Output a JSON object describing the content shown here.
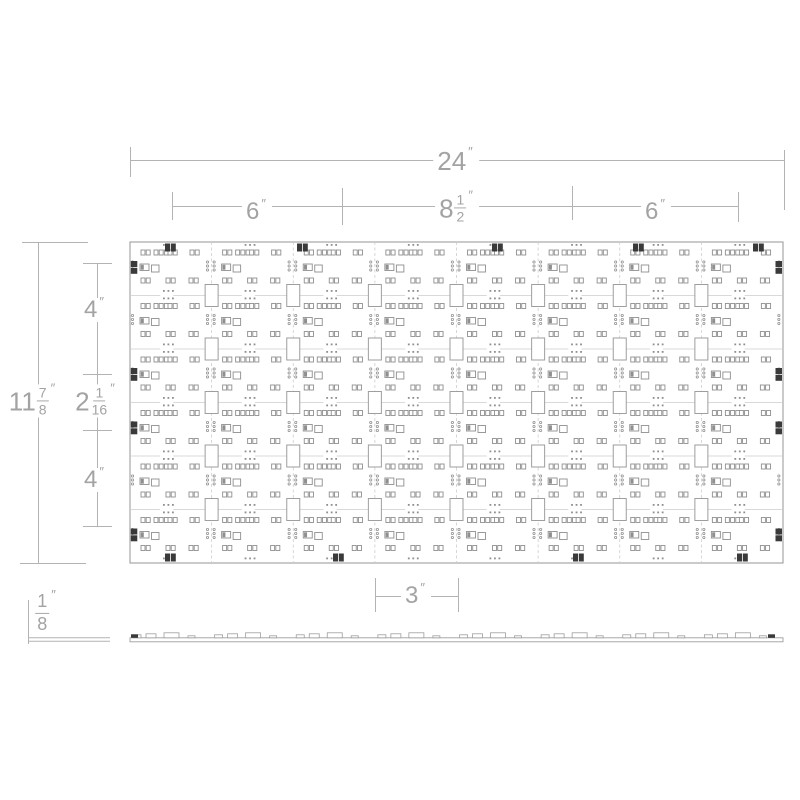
{
  "colors": {
    "dimension_line": "#b3b3b3",
    "dimension_text": "#a3a3a3",
    "board_outline": "#9e9e9e",
    "grid_line": "#cccccc",
    "pad_line": "#8f8f8f",
    "fiducial_dark": "#3a3a3a"
  },
  "dimensions": {
    "width_total": {
      "value": "24",
      "unit": "″"
    },
    "width_left": {
      "value": "6",
      "unit": "″"
    },
    "width_center": {
      "whole": "8",
      "numerator": "1",
      "denominator": "2",
      "unit": "″"
    },
    "width_right": {
      "value": "6",
      "unit": "″"
    },
    "height_total": {
      "whole": "11",
      "numerator": "7",
      "denominator": "8",
      "unit": "″"
    },
    "height_top": {
      "value": "4",
      "unit": "″"
    },
    "height_center": {
      "whole": "2",
      "numerator": "1",
      "denominator": "16",
      "unit": "″"
    },
    "height_bottom": {
      "value": "4",
      "unit": "″"
    },
    "detail_width": {
      "value": "3",
      "unit": "″"
    },
    "thickness": {
      "numerator": "1",
      "denominator": "8",
      "unit": "″"
    }
  },
  "board": {
    "x": 130,
    "y": 242,
    "w": 653,
    "h": 321,
    "cols": 8,
    "rows": 6,
    "tab": {
      "w": 13,
      "h": 22
    },
    "cell_items": [
      [
        "d3",
        33,
        2
      ],
      [
        "pp",
        11,
        8
      ],
      [
        "p3",
        24,
        8
      ],
      [
        "pp",
        38,
        8
      ],
      [
        "pp",
        60,
        8
      ],
      [
        "c3",
        2.5,
        20
      ],
      [
        "ic",
        10,
        22
      ],
      [
        "sq",
        21.5,
        23
      ],
      [
        "c3",
        77.5,
        20
      ],
      [
        "pp",
        11,
        36
      ],
      [
        "pp",
        36,
        36
      ],
      [
        "pp",
        59,
        36
      ],
      [
        "d3",
        33,
        48
      ]
    ],
    "top_dark_marks_x": [
      165,
      297,
      492,
      633,
      753
    ],
    "bottom_dark_marks_x": [
      165,
      333,
      573,
      737
    ],
    "left_dark_rows": [
      0,
      2,
      3,
      5
    ],
    "right_dark_rows": [
      0,
      2,
      3,
      5
    ]
  },
  "side_view": {
    "x": 130,
    "w": 653,
    "y": 637.8,
    "thickness": 4,
    "bumps_per_cell": [
      [
        3,
        8,
        3
      ],
      [
        16,
        10,
        4
      ],
      [
        34,
        15,
        5
      ],
      [
        58,
        7,
        2
      ]
    ],
    "dark_ends": [
      [
        131,
        7,
        3.5
      ],
      [
        768,
        7,
        3.5
      ]
    ]
  }
}
